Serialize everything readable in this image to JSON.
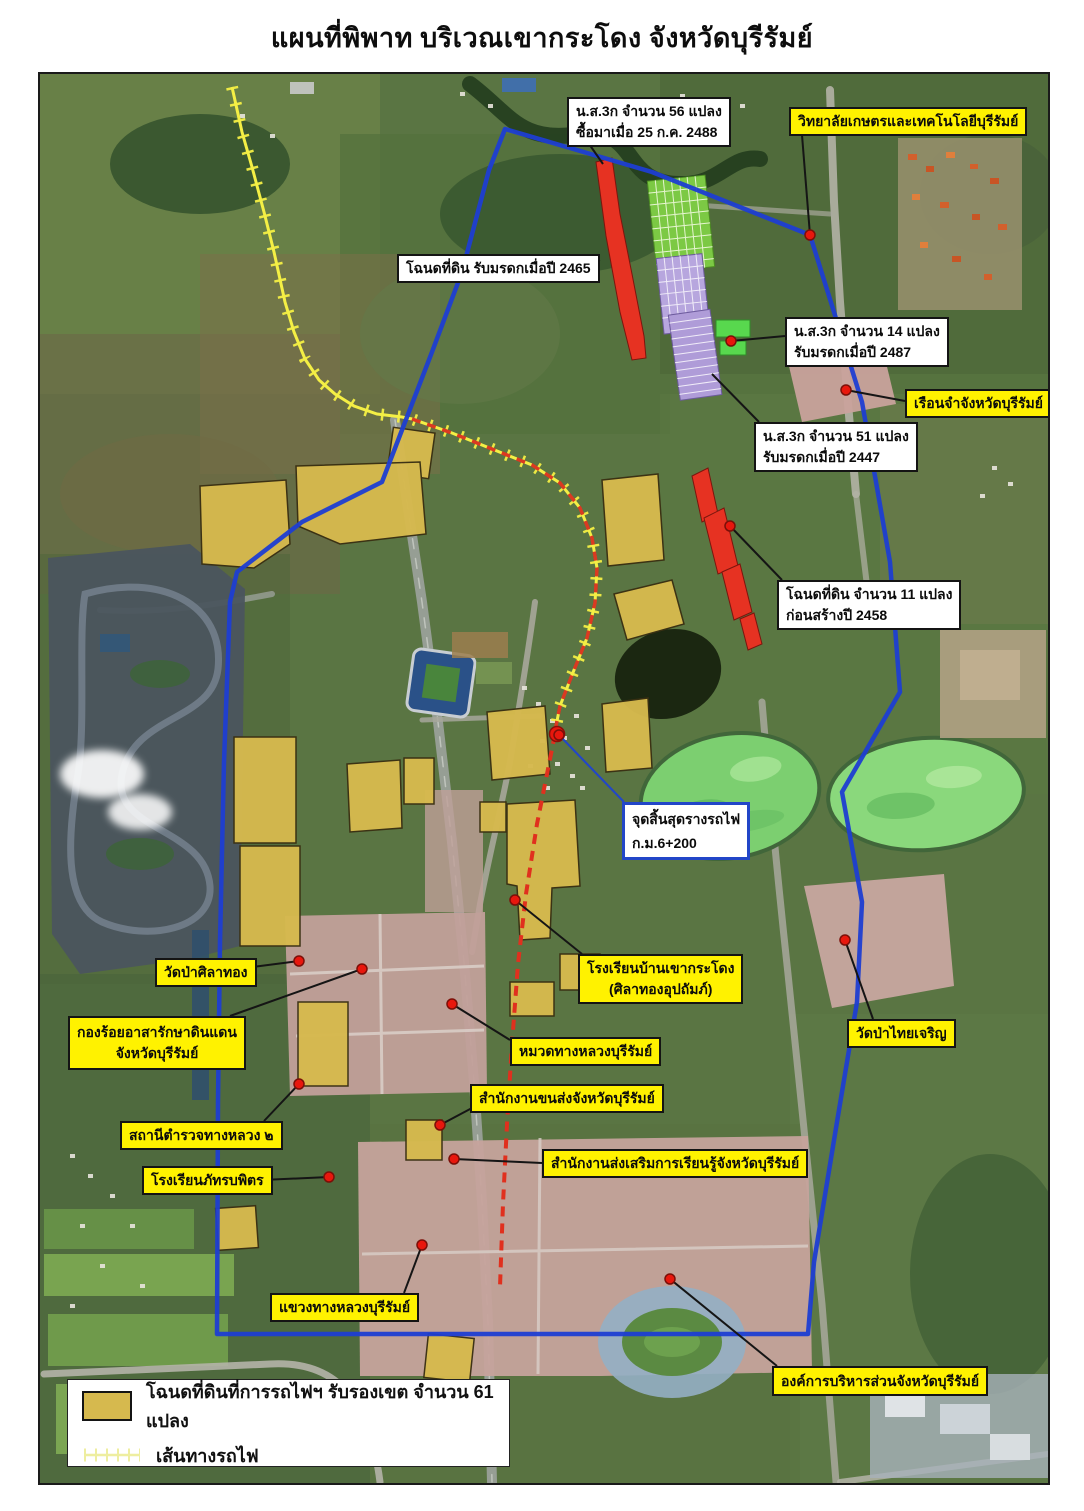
{
  "title": "แผนที่พิพาท บริเวณเขากระโดง จังหวัดบุรีรัมย์",
  "colors": {
    "boundary_blue": "#1e3ed2",
    "railway_yellow": "#f4ef45",
    "rail_red": "#d92f20",
    "parcel_gold": "#d6b94e",
    "parcel_red": "#e63222",
    "parcel_green": "#7cc944",
    "parcel_purple": "#b7a6de",
    "label_yellow": "#fff200",
    "callout_blue_border": "#2246c8",
    "dot_red": "#e8170d",
    "lake_green": "#7ccf70"
  },
  "legend": {
    "items": [
      {
        "symbol": "gold-parcel-swatch",
        "label": "โฉนดที่ดินที่การรถไฟฯ รับรองเขต จำนวน 61 แปลง"
      },
      {
        "symbol": "railway-line-symbol",
        "label": "เส้นทางรถไฟ"
      }
    ]
  },
  "labels": [
    {
      "id": "ns3k-56",
      "style": "white",
      "lines": [
        "น.ส.3ก จำนวน 56 แปลง",
        "ซื้อมาเมื่อ 25 ก.ค. 2488"
      ],
      "box": [
        527,
        23,
        124,
        44
      ],
      "leader": [
        [
          547,
          67
        ],
        [
          563,
          90
        ]
      ],
      "dot": null
    },
    {
      "id": "kaset-college",
      "style": "yellow",
      "lines": [
        "วิทยาลัยเกษตรและเทคโนโลยีบุรีรัมย์"
      ],
      "box": [
        749,
        33,
        226,
        28
      ],
      "leader": [
        [
          762,
          61
        ],
        [
          770,
          161
        ]
      ],
      "dot": [
        770,
        161
      ]
    },
    {
      "id": "chanote-2465",
      "style": "white",
      "lines": [
        "โฉนดที่ดิน รับมรดกเมื่อปี 2465"
      ],
      "box": [
        357,
        180,
        155,
        28
      ],
      "leader": [
        [
          512,
          194
        ],
        [
          560,
          186
        ]
      ],
      "dot": null
    },
    {
      "id": "ns3k-14",
      "style": "white",
      "lines": [
        "น.ส.3ก จำนวน 14 แปลง",
        "รับมรดกเมื่อปี 2487"
      ],
      "box": [
        745,
        243,
        134,
        46
      ],
      "leader": [
        [
          745,
          262
        ],
        [
          691,
          267
        ]
      ],
      "dot": [
        691,
        267
      ]
    },
    {
      "id": "prison",
      "style": "yellow",
      "lines": [
        "เรือนจำจังหวัดบุรีรัมย์"
      ],
      "box": [
        865,
        315,
        136,
        26
      ],
      "leader": [
        [
          865,
          327
        ],
        [
          806,
          316
        ]
      ],
      "dot": [
        806,
        316
      ]
    },
    {
      "id": "ns3k-51",
      "style": "white",
      "lines": [
        "น.ส.3ก จำนวน 51 แปลง",
        "รับมรดกเมื่อปี 2447"
      ],
      "box": [
        714,
        348,
        128,
        46
      ],
      "leader": [
        [
          719,
          348
        ],
        [
          672,
          300
        ]
      ],
      "dot": null
    },
    {
      "id": "chanote-11",
      "style": "white",
      "lines": [
        "โฉนดที่ดิน จำนวน 11 แปลง",
        "ก่อนสร้างปี 2458"
      ],
      "box": [
        737,
        506,
        150,
        46
      ],
      "leader": [
        [
          742,
          506
        ],
        [
          690,
          452
        ]
      ],
      "dot": [
        690,
        452
      ]
    },
    {
      "id": "rail-end",
      "style": "white-blue",
      "lines": [
        "จุดสิ้นสุดรางรถไฟ",
        "ก.ม.6+200"
      ],
      "box": [
        582,
        728,
        114,
        58
      ],
      "leader": [
        [
          584,
          728
        ],
        [
          519,
          661
        ]
      ],
      "dot": [
        519,
        661
      ]
    },
    {
      "id": "school-khao-kradong",
      "style": "yellow",
      "lines": [
        "โรงเรียนบ้านเขากระโดง",
        "(ศิลาทองอุปถัมภ์)"
      ],
      "box": [
        538,
        880,
        118,
        50
      ],
      "leader": [
        [
          542,
          880
        ],
        [
          475,
          826
        ]
      ],
      "dot": [
        475,
        826
      ]
    },
    {
      "id": "wat-silathong",
      "style": "yellow",
      "lines": [
        "วัดป่าศิลาทอง"
      ],
      "box": [
        115,
        884,
        82,
        25
      ],
      "leader": [
        [
          197,
          895
        ],
        [
          259,
          887
        ]
      ],
      "dot": [
        259,
        887
      ]
    },
    {
      "id": "kong-roi",
      "style": "yellow",
      "lines": [
        "กองร้อยอาสารักษาดินแดน",
        "จังหวัดบุรีรัมย์"
      ],
      "box": [
        28,
        942,
        170,
        54
      ],
      "leader": [
        [
          190,
          942
        ],
        [
          322,
          895
        ]
      ],
      "dot": [
        322,
        895
      ]
    },
    {
      "id": "muad-thang-luang",
      "style": "yellow",
      "lines": [
        "หมวดทางหลวงบุรีรัมย์"
      ],
      "box": [
        470,
        963,
        144,
        26
      ],
      "leader": [
        [
          470,
          966
        ],
        [
          412,
          930
        ]
      ],
      "dot": [
        412,
        930
      ]
    },
    {
      "id": "khonsong",
      "style": "yellow",
      "lines": [
        "สำนักงานขนส่งจังหวัดบุรีรัมย์"
      ],
      "box": [
        430,
        1010,
        184,
        26
      ],
      "leader": [
        [
          432,
          1034
        ],
        [
          400,
          1051
        ]
      ],
      "dot": [
        400,
        1051
      ]
    },
    {
      "id": "highway-police",
      "style": "yellow",
      "lines": [
        "สถานีตำรวจทางหลวง ๒"
      ],
      "box": [
        80,
        1047,
        156,
        28
      ],
      "leader": [
        [
          224,
          1047
        ],
        [
          259,
          1010
        ]
      ],
      "dot": [
        259,
        1010
      ]
    },
    {
      "id": "learning-office",
      "style": "yellow",
      "lines": [
        "สำนักงานส่งเสริมการเรียนรู้จังหวัดบุรีรัมย์"
      ],
      "box": [
        502,
        1075,
        246,
        29
      ],
      "leader": [
        [
          502,
          1089
        ],
        [
          414,
          1085
        ]
      ],
      "dot": [
        414,
        1085
      ]
    },
    {
      "id": "phattara-school",
      "style": "yellow",
      "lines": [
        "โรงเรียนภัทรบพิตร"
      ],
      "box": [
        102,
        1092,
        120,
        27
      ],
      "leader": [
        [
          222,
          1106
        ],
        [
          289,
          1103
        ]
      ],
      "dot": [
        289,
        1103
      ]
    },
    {
      "id": "kwaeng-thang-luang",
      "style": "yellow",
      "lines": [
        "แขวงทางหลวงบุรีรัมย์"
      ],
      "box": [
        230,
        1219,
        146,
        28
      ],
      "leader": [
        [
          364,
          1219
        ],
        [
          382,
          1171
        ]
      ],
      "dot": [
        382,
        1171
      ]
    },
    {
      "id": "wat-thai-charoen",
      "style": "yellow",
      "lines": [
        "วัดป่าไทยเจริญ"
      ],
      "box": [
        807,
        945,
        88,
        27
      ],
      "leader": [
        [
          833,
          945
        ],
        [
          805,
          866
        ]
      ],
      "dot": [
        805,
        866
      ]
    },
    {
      "id": "abj-buriram",
      "style": "yellow",
      "lines": [
        "องค์การบริหารส่วนจังหวัดบุรีรัมย์"
      ],
      "box": [
        732,
        1292,
        200,
        30
      ],
      "leader": [
        [
          737,
          1292
        ],
        [
          630,
          1205
        ]
      ],
      "dot": [
        630,
        1205
      ]
    }
  ]
}
